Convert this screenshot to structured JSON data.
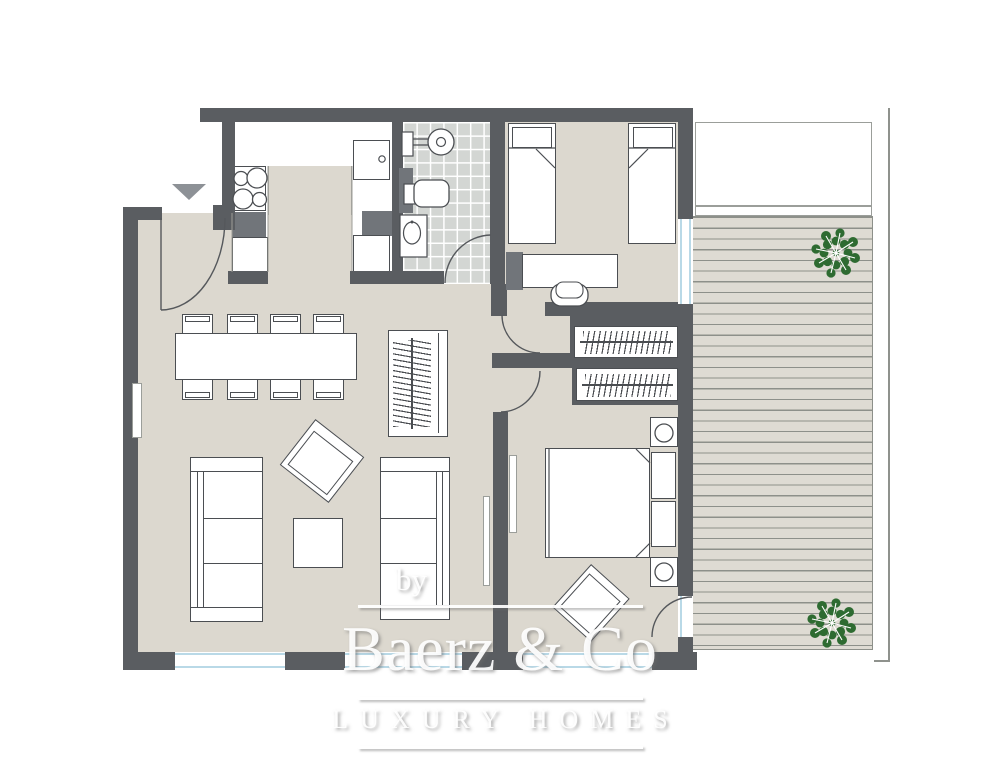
{
  "branding": {
    "prefix": "by",
    "name": "Baerz & Co",
    "tagline": "LUXURY HOMES"
  },
  "palette": {
    "wall": "#5a5d61",
    "floor": "#dcd8cf",
    "tile": "#d3d6d3",
    "tile_grout": "#ffffff",
    "deck": "#dedbd3",
    "deck_line": "#8d908a",
    "outline": "#4b4e52",
    "accent_gray": "#71757a",
    "window_blue": "#b9d9e7",
    "tree_green": "#2e6b31",
    "watermark": "#ffffff"
  },
  "icons": {
    "entrance_arrow": "triangle-down",
    "tree": "tree-top-view"
  }
}
